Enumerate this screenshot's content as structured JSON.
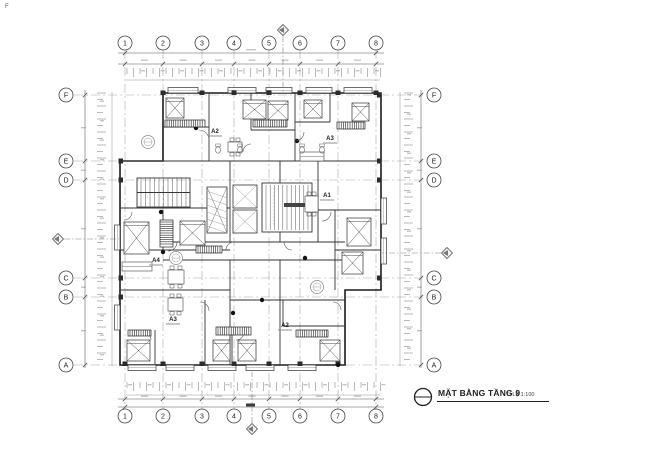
{
  "document": {
    "type": "architectural-floor-plan",
    "stray_mark": "F"
  },
  "title_block": {
    "name": "MẶT BẰNG TẦNG 9",
    "scale": "TỈ LỆ 1:100"
  },
  "grid": {
    "columns": [
      "1",
      "2",
      "3",
      "4",
      "5",
      "6",
      "7",
      "8"
    ],
    "rows": [
      "F",
      "E",
      "D",
      "C",
      "B",
      "A"
    ]
  },
  "units": [
    {
      "label": "A2"
    },
    {
      "label": "A3"
    },
    {
      "label": "A1"
    },
    {
      "label": "A4"
    },
    {
      "label": "A3"
    },
    {
      "label": "A2"
    }
  ],
  "colors": {
    "wall": "#1b1b1b",
    "partition": "#333333",
    "dim": "#555555",
    "grid_line": "#9a9a9a",
    "furniture": "#444444",
    "smudge": "#8a8a8a"
  }
}
